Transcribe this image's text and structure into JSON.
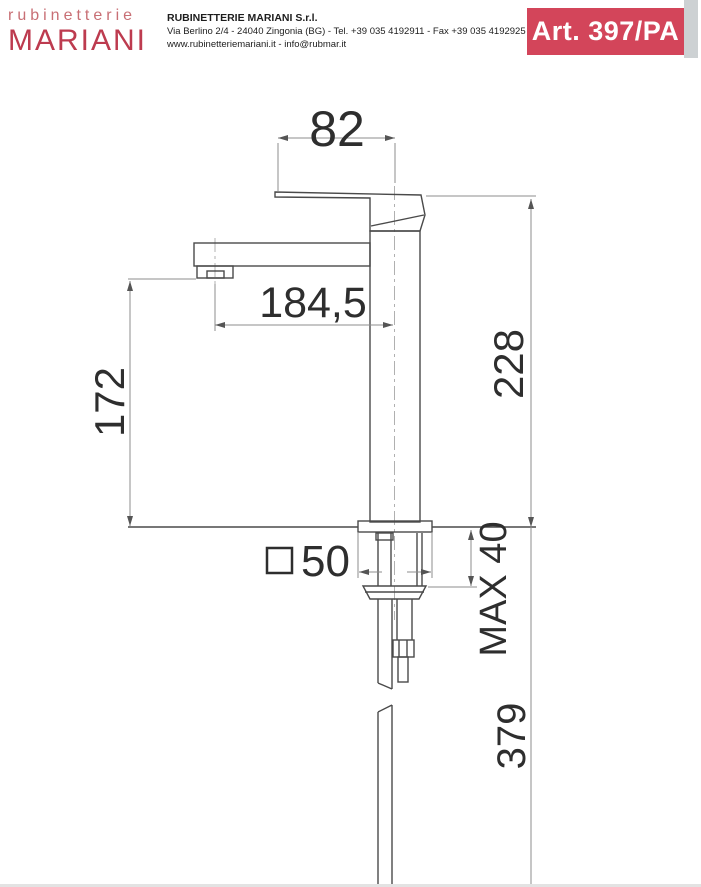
{
  "header": {
    "logo_line1": "rubinetterie",
    "logo_line2": "MARIANI",
    "company_name": "RUBINETTERIE MARIANI S.r.l.",
    "company_address": "Via Berlino 2/4 - 24040 Zingonia (BG) - Tel. +39 035 4192911 - Fax +39 035 4192925",
    "company_web": "www.rubinetteriemariani.it - info@rubmar.it",
    "article_code": "Art. 397/PA"
  },
  "drawing": {
    "description": "Side-view technical drawing of a tall single-lever basin mixer tap with installation dimensions in millimetres",
    "dims": {
      "handle_width": "82",
      "spout_reach": "184,5",
      "spout_height": "172",
      "overall_height": "228",
      "max_deck_thickness": "MAX 40",
      "below_deck_length": "379",
      "body_square_size": "50"
    },
    "colors": {
      "accent_red": "#d3455a",
      "logo_red": "#bd3b4f",
      "logo_light_red": "#c86f75",
      "line_gray": "#4a4a4a",
      "dim_gray": "#8c8c8c"
    }
  }
}
